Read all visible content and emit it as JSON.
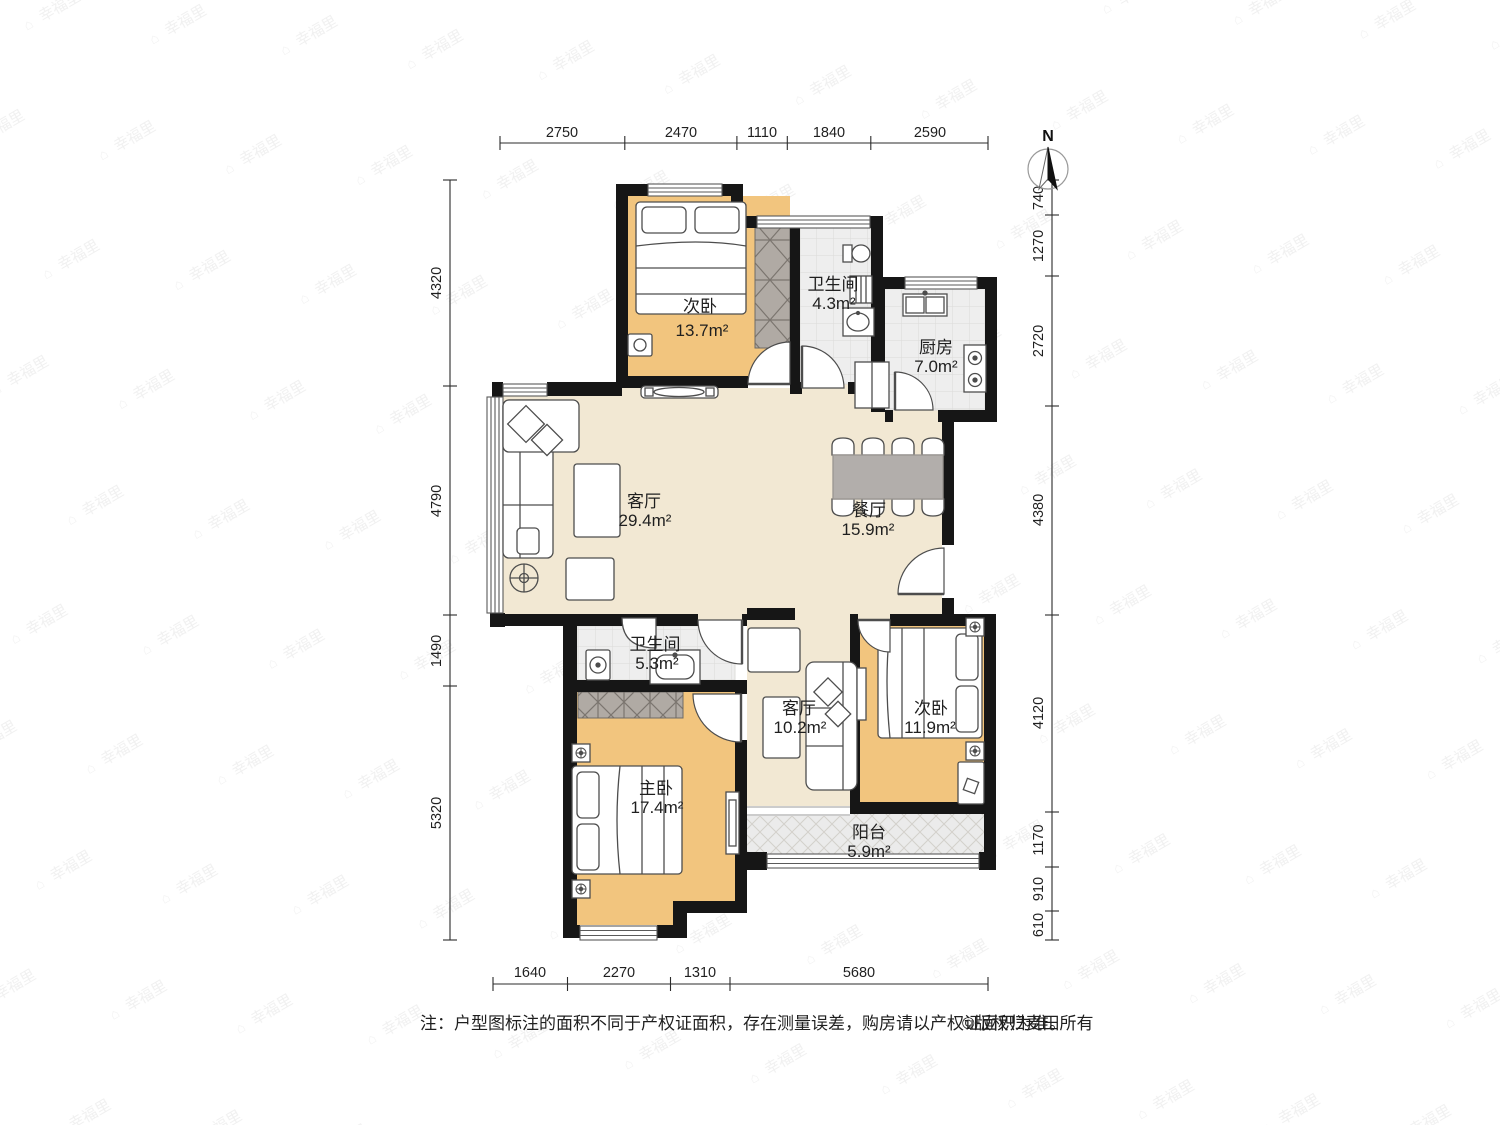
{
  "compass": {
    "label": "N"
  },
  "watermark": {
    "icon": "⌂",
    "text": "幸福里"
  },
  "rooms": [
    {
      "id": "bedroom-top",
      "name": "次卧",
      "area": "13.7m²"
    },
    {
      "id": "bath-top",
      "name": "卫生间",
      "area": "4.3m²"
    },
    {
      "id": "kitchen",
      "name": "厨房",
      "area": "7.0m²"
    },
    {
      "id": "living",
      "name": "客厅",
      "area": "29.4m²"
    },
    {
      "id": "dining",
      "name": "餐厅",
      "area": "15.9m²"
    },
    {
      "id": "bath-mid",
      "name": "卫生间",
      "area": "5.3m²"
    },
    {
      "id": "family",
      "name": "客厅",
      "area": "10.2m²"
    },
    {
      "id": "bedroom-right",
      "name": "次卧",
      "area": "11.9m²"
    },
    {
      "id": "master",
      "name": "主卧",
      "area": "17.4m²"
    },
    {
      "id": "balcony",
      "name": "阳台",
      "area": "5.9m²"
    }
  ],
  "dims": {
    "top": [
      "2750",
      "2470",
      "1110",
      "1840",
      "2590"
    ],
    "right": [
      "740",
      "1270",
      "2720",
      "4380",
      "4120",
      "1170",
      "910",
      "610"
    ],
    "left": [
      "4320",
      "4790",
      "1490",
      "5320"
    ],
    "bottom": [
      "1640",
      "2270",
      "1310",
      "5680"
    ]
  },
  "note": {
    "text": "注：户型图标注的面积不同于产权证面积，存在测量误差，购房请以产权证面积为准。",
    "copyright": "©版权归麦田所有"
  }
}
